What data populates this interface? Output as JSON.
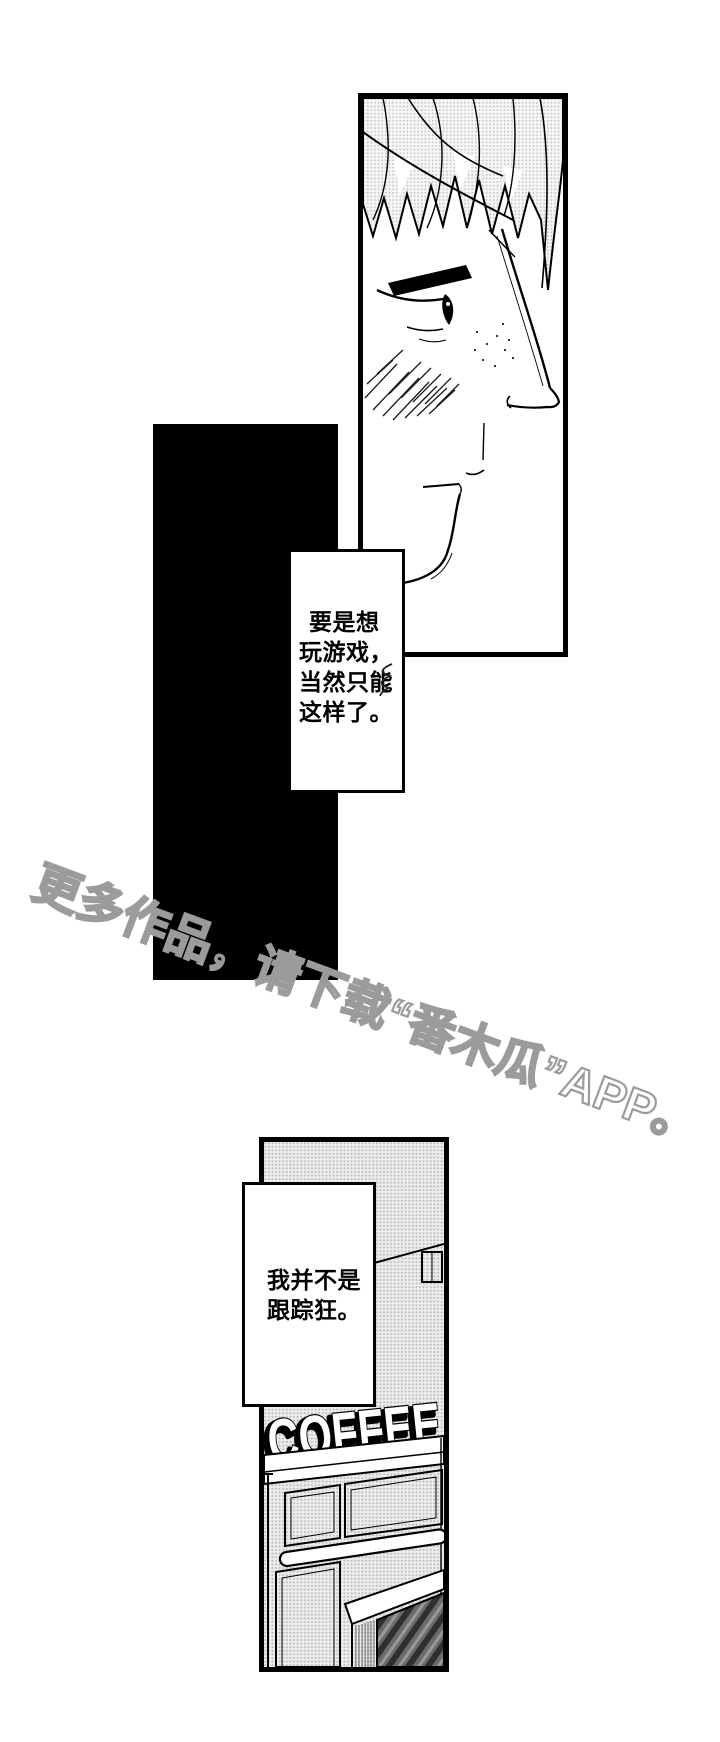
{
  "page": {
    "width": 720,
    "height": 1742,
    "background": "#ffffff",
    "type": "manga-page"
  },
  "bubble_1": {
    "lines": [
      "要是想",
      "玩游戏，",
      "当然只能",
      "这样了。"
    ]
  },
  "bubble_2": {
    "lines": [
      "我并不是",
      "跟踪狂。"
    ]
  },
  "watermark": {
    "text": "更多作品，请下载“番木瓜”APP。",
    "color": "#9b9b9b"
  },
  "coffee_sign": {
    "text": "COFFEE"
  },
  "colors": {
    "ink": "#000000",
    "paper": "#ffffff",
    "screentone_dot": "#b7b7b7",
    "watermark_outline": "#9b9b9b"
  }
}
